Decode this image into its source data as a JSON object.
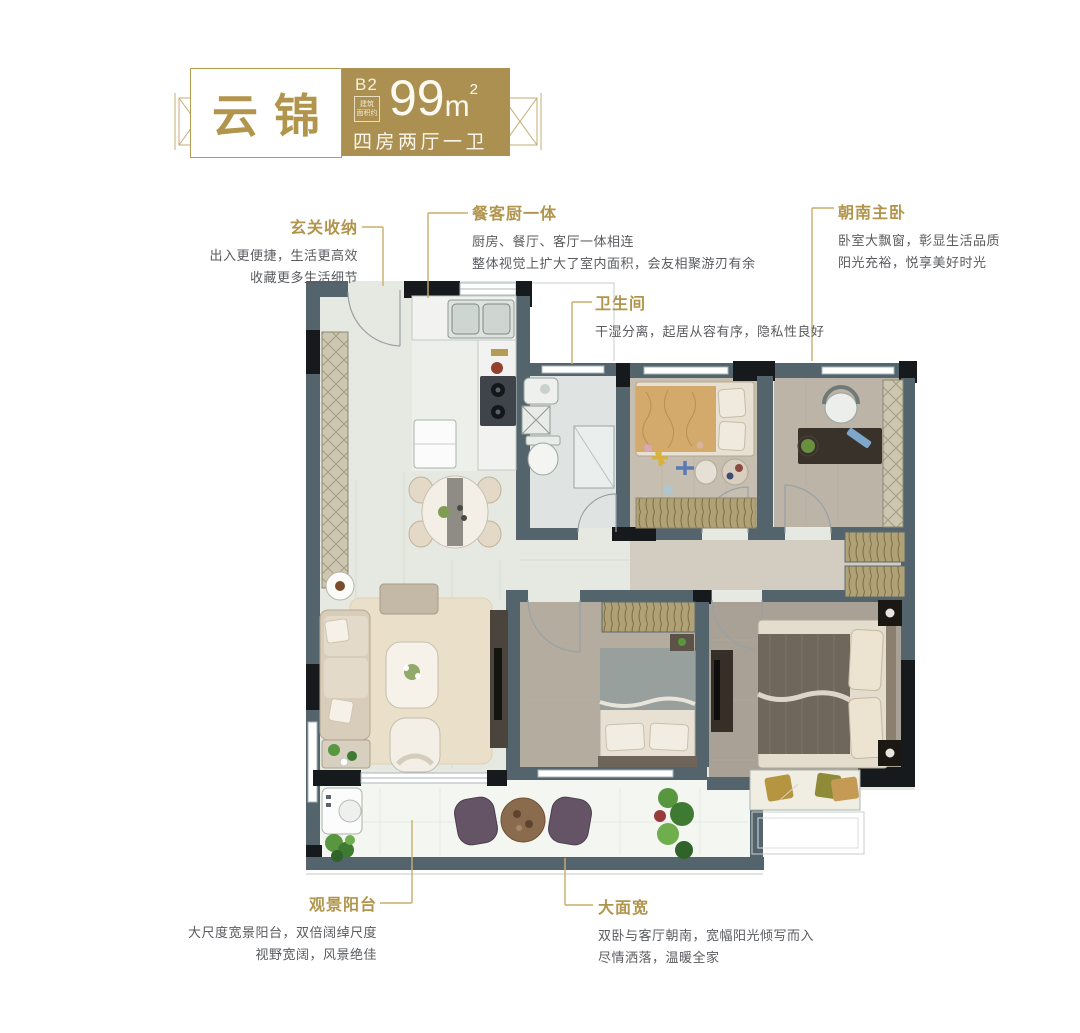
{
  "header": {
    "project_name": "云锦",
    "unit_label": "B2",
    "stamp_line1": "建筑",
    "stamp_line2": "面积约",
    "area_value": "99",
    "area_unit": "m",
    "area_exponent": "2",
    "layout_text": "四房两厅一卫"
  },
  "annotations": [
    {
      "id": "entry-storage",
      "title": "玄关收纳",
      "lines": [
        "出入更便捷，生活更高效",
        "收藏更多生活细节"
      ]
    },
    {
      "id": "dining-kitchen",
      "title": "餐客厨一体",
      "lines": [
        "厨房、餐厅、客厅一体相连",
        "整体视觉上扩大了室内面积，会友相聚游刃有余"
      ]
    },
    {
      "id": "south-master",
      "title": "朝南主卧",
      "lines": [
        "卧室大飘窗，彰显生活品质",
        "阳光充裕，悦享美好时光"
      ]
    },
    {
      "id": "bathroom",
      "title": "卫生间",
      "lines": [
        "干湿分离，起居从容有序，隐私性良好"
      ]
    },
    {
      "id": "view-balcony",
      "title": "观景阳台",
      "lines": [
        "大尺度宽景阳台，双倍阔绰尺度",
        "视野宽阔，风景绝佳"
      ]
    },
    {
      "id": "wide-frontage",
      "title": "大面宽",
      "lines": [
        "双卧与客厅朝南，宽幅阳光倾写而入",
        "尽情洒落，温暖全家"
      ]
    }
  ],
  "colors": {
    "brand_gold": "#ab9052",
    "gold_text": "#b2954c",
    "body_text": "#595b5e",
    "leader_line": "#c9ae6b",
    "wall": "#54646d",
    "wall_dark": "#171a1c"
  }
}
